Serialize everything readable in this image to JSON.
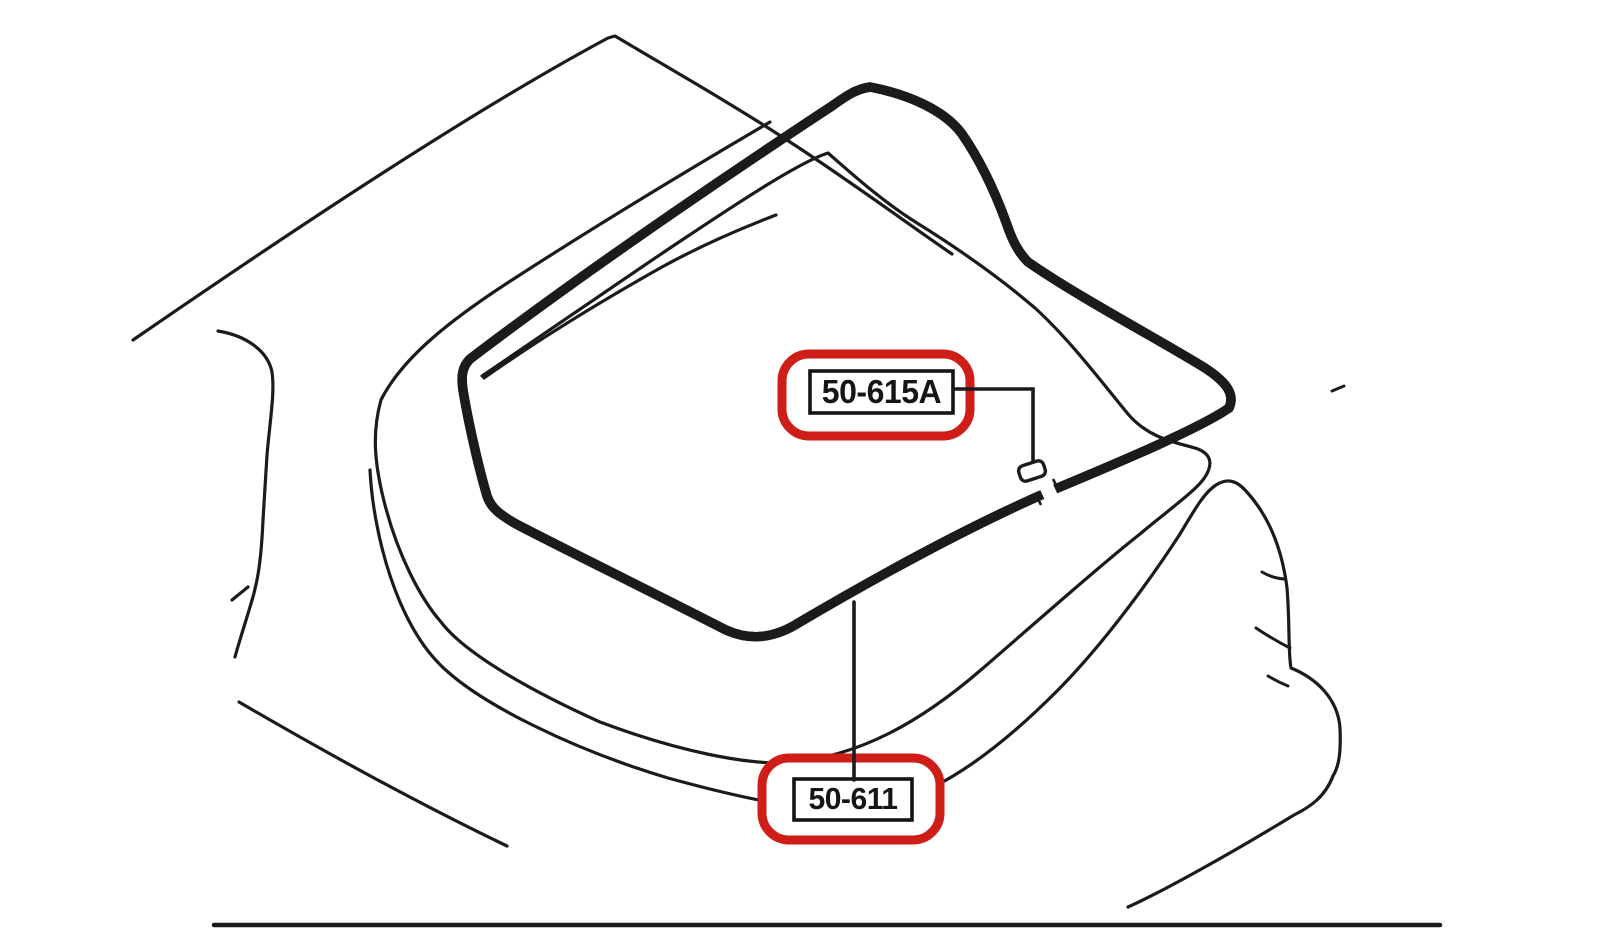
{
  "diagram": {
    "description": "rear hatch weatherstrip parts line drawing",
    "background_color": "#ffffff",
    "line_color": "#1b1b1b",
    "highlight_color": "#cf1e17",
    "callouts": [
      {
        "label": "50-615A",
        "highlighted": true,
        "leader": "right-angle leader to small joint clip on seal"
      },
      {
        "label": "50-611",
        "highlighted": true,
        "leader": "vertical leader to lower edge of seal loop"
      }
    ]
  }
}
